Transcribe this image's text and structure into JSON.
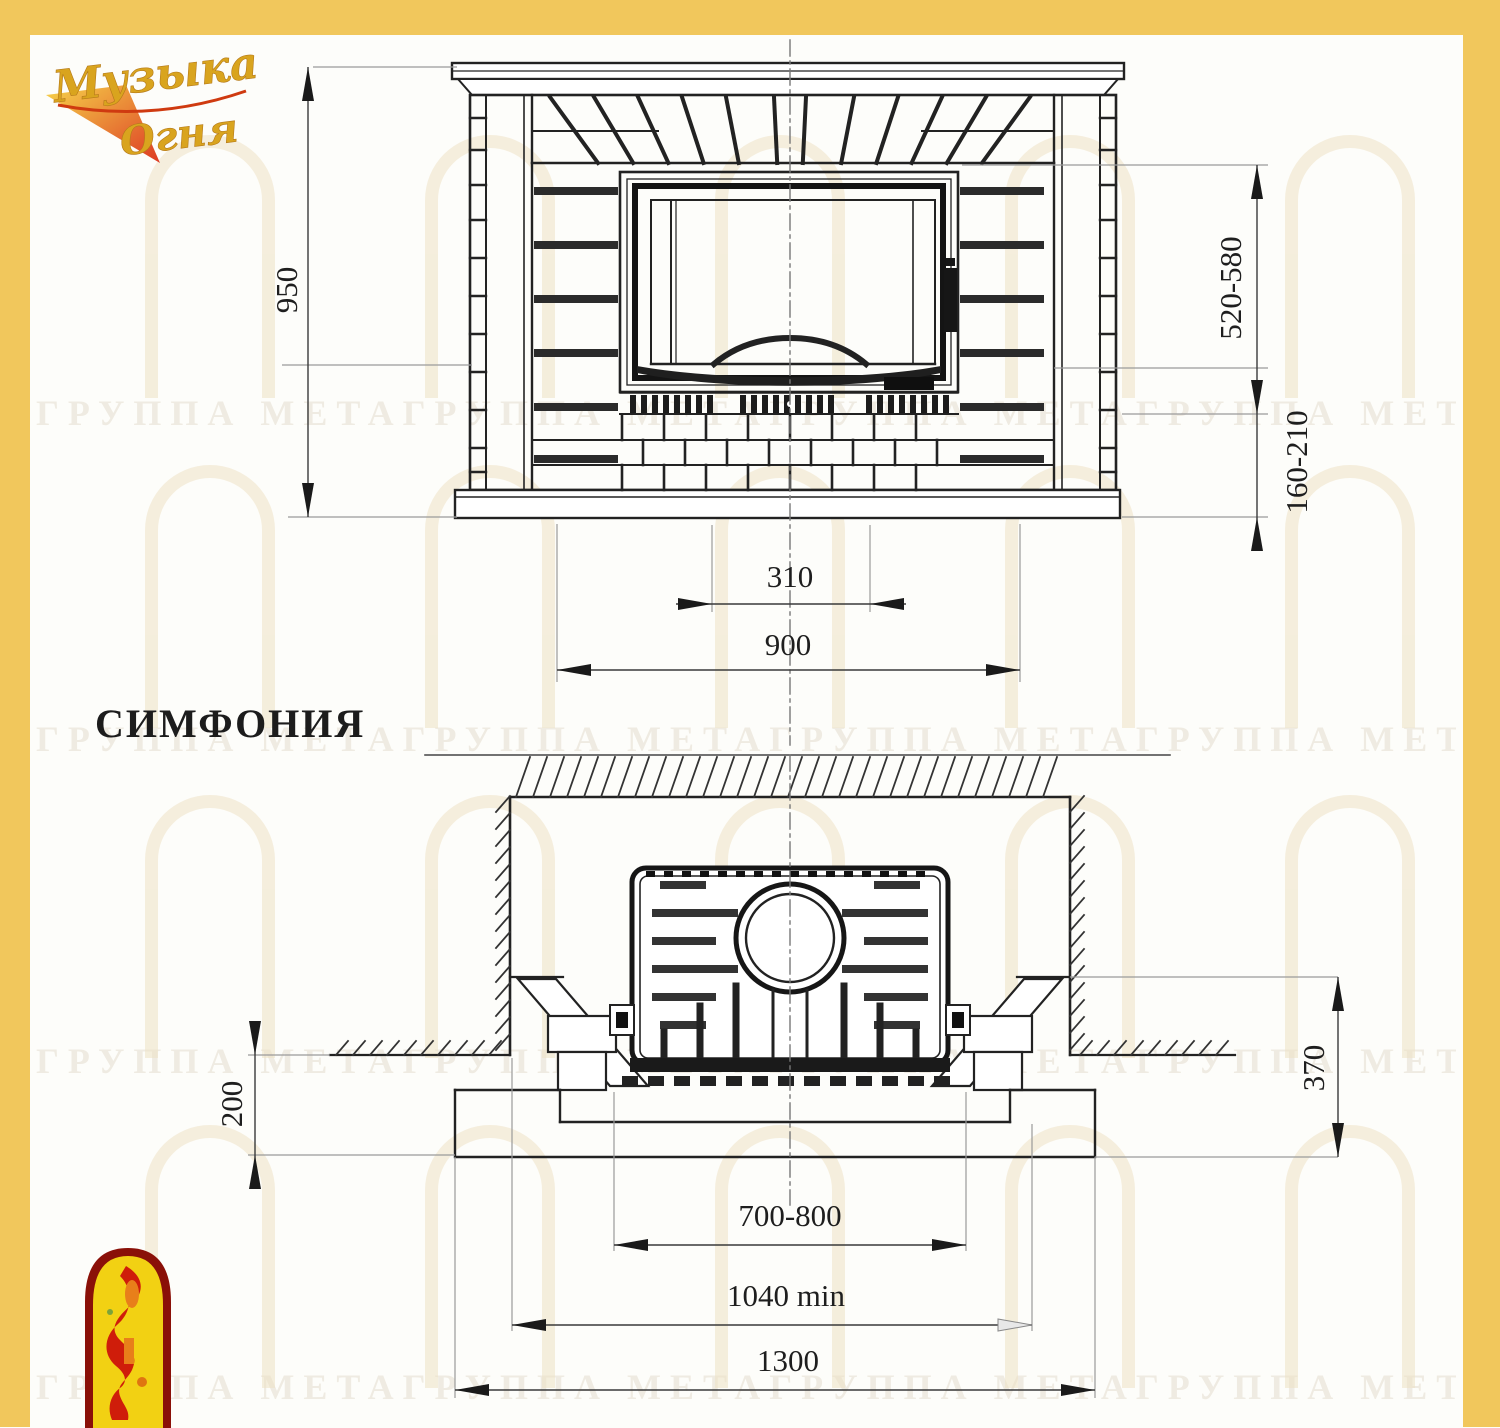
{
  "labels": {
    "title": "СИМФОНИЯ",
    "logo_line1": "Музыка",
    "logo_line2": "Огня"
  },
  "front_view": {
    "overall_height": "950",
    "firebox_opening_height": "520-580",
    "hearth_height": "160-210",
    "vent_width": "310",
    "overall_width": "900"
  },
  "plan_view": {
    "hearth_projection": "200",
    "portal_depth": "370",
    "firebox_width": "700-800",
    "niche_width_min": "1040 min",
    "overall_width": "1300"
  },
  "watermark": {
    "text": "ГРУППА МЕТАГРУППА МЕТАГРУППА МЕТАГРУППА МЕТАГРУППА МЕТА"
  },
  "colors": {
    "border_yellow": "#F1C75C",
    "ink": "#1e1e1e",
    "logo_gold": "#D9A41E",
    "logo_red": "#CF1D0A",
    "emblem_yellow": "#F2D113",
    "emblem_dark_red": "#8A1008"
  }
}
